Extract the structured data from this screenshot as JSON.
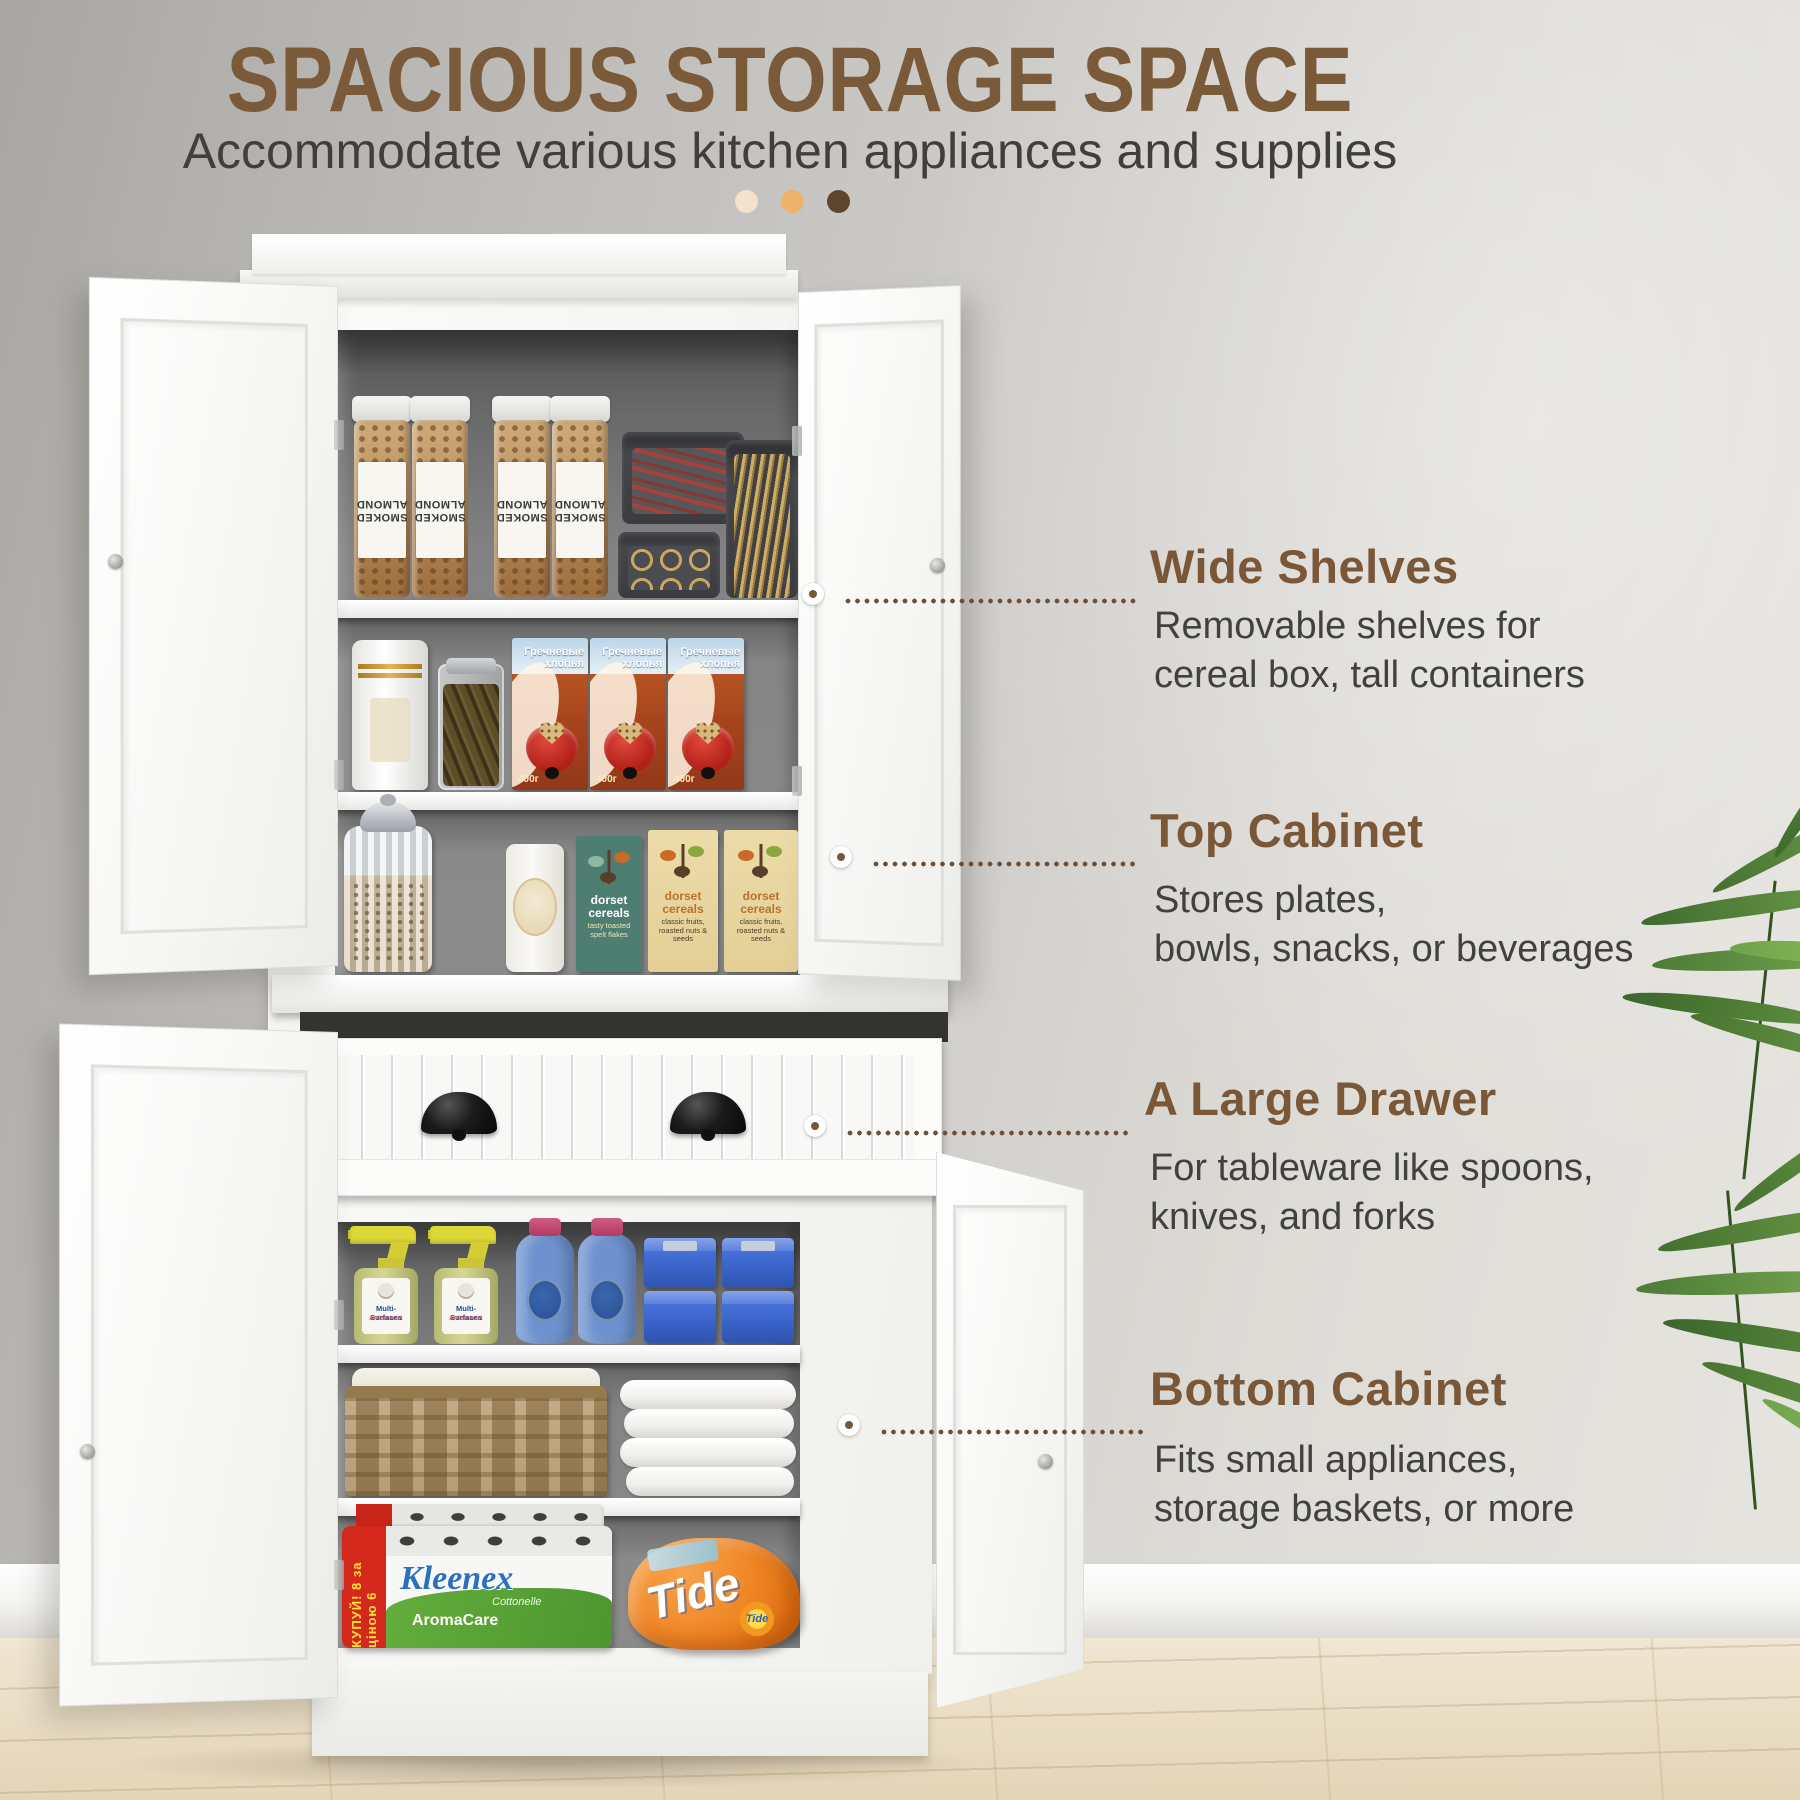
{
  "header": {
    "title": "SPACIOUS STORAGE SPACE",
    "subtitle": "Accommodate various kitchen appliances and supplies"
  },
  "callouts": [
    {
      "title": "Wide Shelves",
      "line1": "Removable shelves for",
      "line2": "cereal box, tall containers"
    },
    {
      "title": "Top Cabinet",
      "line1": "Stores plates,",
      "line2": "bowls, snacks, or beverages"
    },
    {
      "title": "A Large Drawer",
      "line1": "For tableware like spoons,",
      "line2": "knives, and forks"
    },
    {
      "title": "Bottom Cabinet",
      "line1": "Fits small appliances,",
      "line2": "storage baskets, or more"
    }
  ],
  "cabinet_items": {
    "almond_jar_label": "SMOKED ALMOND",
    "cereal_box_title": "Гречневые хлопья",
    "cereal_box_weight": "400г",
    "dorset_brand": "dorset cereals",
    "dorset_teal_sub": "tasty toasted spelt flakes",
    "dorset_cream_sub": "classic fruits, roasted nuts & seeds",
    "spray_label_line1": "Multi-Surfaces",
    "spray_label_line2": "Antibacterial",
    "tissue_brand": "Kleenex",
    "tissue_sub": "Cottonelle",
    "tissue_line": "AromaCare",
    "tissue_promo": "КУПУЙ! 8 за ціною 6",
    "detergent_brand": "Tide",
    "detergent_logo": "Tide"
  },
  "colors": {
    "accent_brown": "#7a5837",
    "title_brown": "#7b5a39",
    "text_dark": "#42413d",
    "header_dot_1": "#f3e2cc",
    "header_dot_2": "#eeb269",
    "header_dot_3": "#5d452e",
    "leader_dot": "#6e4f33"
  }
}
